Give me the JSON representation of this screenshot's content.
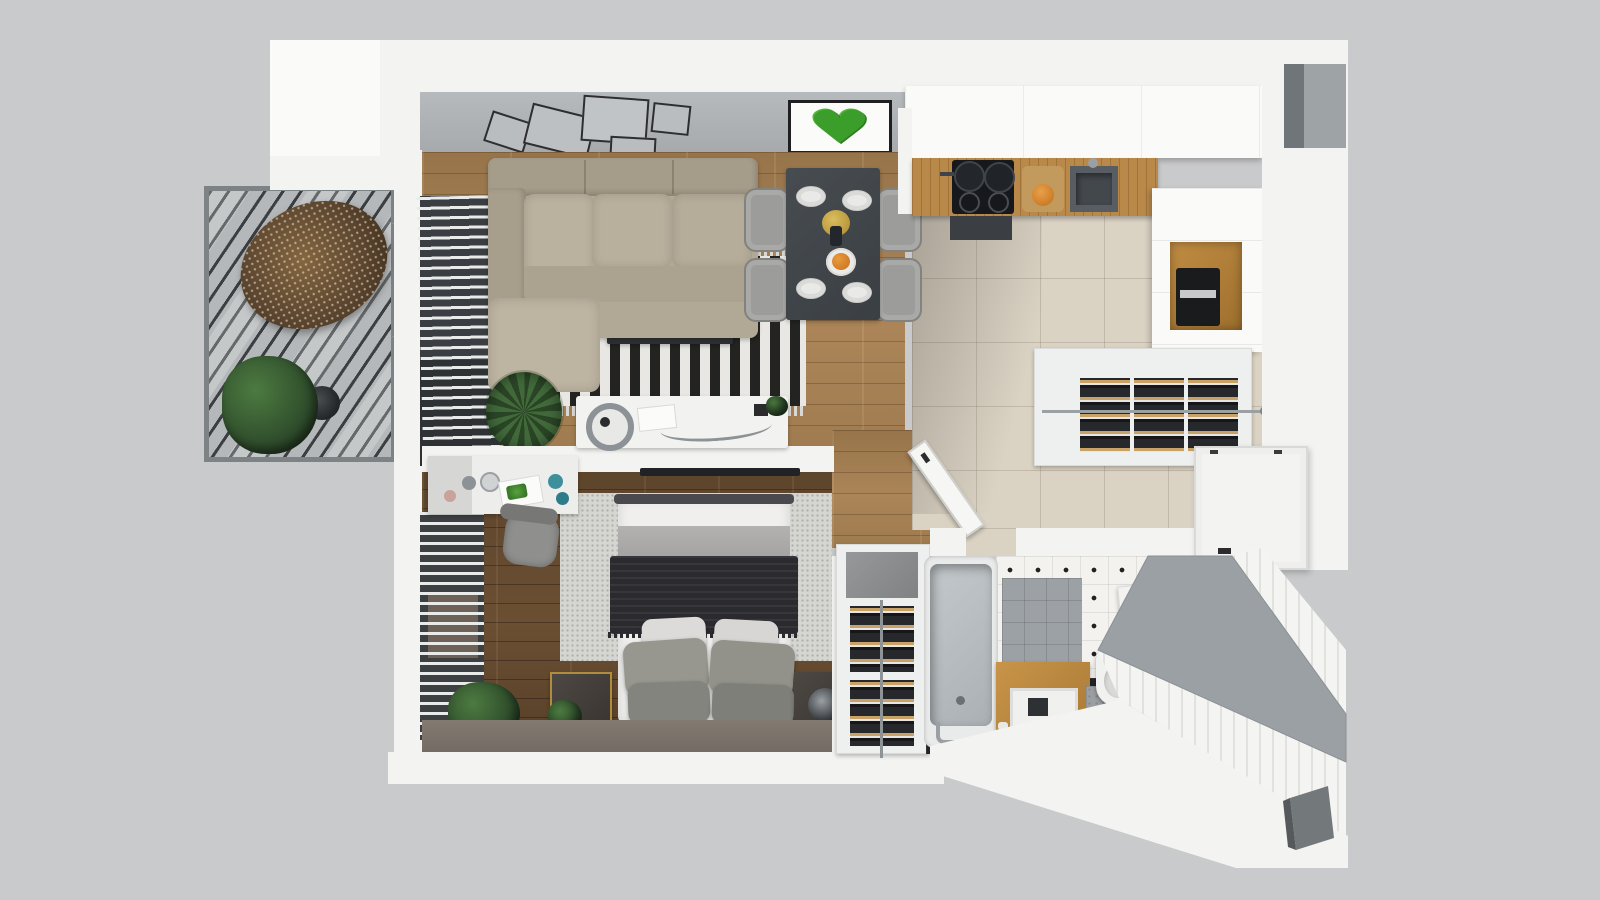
{
  "scene": {
    "title": "3D top-down floor plan of a one-bedroom apartment",
    "background": "#c9cacb",
    "palette": {
      "backdrop": "#c9cacb",
      "wall": "#f3f3f1",
      "gallery_wall": "#aeb2b5",
      "wood_living": "#a17c50",
      "wood_bedroom": "#63492f",
      "kitchen_tile": "#dad2c3",
      "rug_black": "#232421",
      "rug_white": "#e8e7e3",
      "sofa_beige": "#b7ad9b",
      "dining_table": "#41464b",
      "counter_oak": "#b9894a",
      "moss_green": "#3c9e2a",
      "throw_charcoal": "#2b2b2f",
      "bench_gray": "#9aa0a3",
      "black_tile": "#232428"
    },
    "rooms": [
      {
        "label": "Balcony",
        "items": [
          "hanging egg chair",
          "potted plant",
          "side stool",
          "slatted pergola shade",
          "deck"
        ]
      },
      {
        "label": "Living room",
        "items": [
          "corner sofa",
          "black-white striped rug",
          "media bench",
          "gold bowl",
          "console table",
          "table lamp",
          "palm plant",
          "window blinds",
          "gallery wall with five frames",
          "moss heart artwork"
        ]
      },
      {
        "label": "Dining area",
        "items": [
          "dark dining table",
          "four gray chairs",
          "four place settings",
          "gold charger",
          "fruit plate"
        ]
      },
      {
        "label": "Kitchen",
        "items": [
          "oak countertop",
          "induction hob with two pots",
          "cutting board",
          "orange pitcher",
          "sink",
          "upper cabinet run",
          "tall cabinets",
          "oak coffee-machine niche",
          "coffee machine"
        ]
      },
      {
        "label": "Hallway",
        "items": [
          "pull-out shoe racks with shoes",
          "hanging rail",
          "entrance door",
          "beige tile floor"
        ]
      },
      {
        "label": "Bedroom",
        "items": [
          "double bed",
          "gray blanket",
          "charcoal throw",
          "six pillows",
          "speckled area rug",
          "desk with magazines and cups",
          "desk chair",
          "two dark nightstands",
          "round vase",
          "window blinds",
          "floor plants",
          "wall TV"
        ]
      },
      {
        "label": "Bathroom",
        "items": [
          "bathtub",
          "tub faucet",
          "oak vanity with sink",
          "wall-hung toilet",
          "washing machine",
          "shoe tower with open lid",
          "open door",
          "diamond-dot tile floor",
          "gray shower tile",
          "black tile floor",
          "gray bench ledge",
          "tiled outer wall",
          "wall niche"
        ]
      }
    ]
  }
}
